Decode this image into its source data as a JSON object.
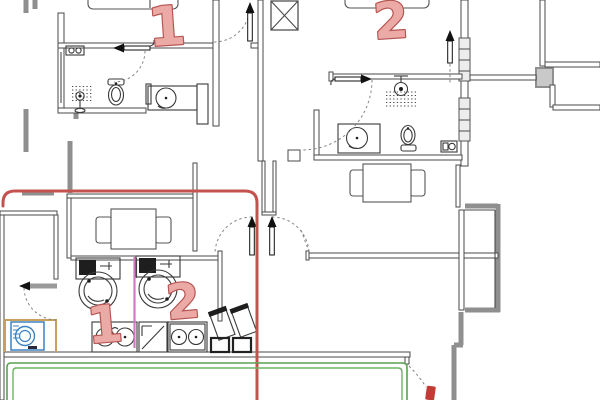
{
  "plan": {
    "type": "apartment floor plan with annotations",
    "room_labels": [
      {
        "id": "bedroom-1",
        "text": "1"
      },
      {
        "id": "bedroom-2",
        "text": "2"
      },
      {
        "id": "wash-station-1",
        "text": "1"
      },
      {
        "id": "wash-station-2",
        "text": "2"
      }
    ]
  },
  "colors": {
    "annotation_red": "#c4524e",
    "annotation_green": "#58a24f",
    "annotation_green_inner": "#6db364",
    "annotation_magenta": "#d07cc5",
    "mark_red": "#c23b36",
    "label_fill": "#ecaaa6",
    "label_stroke": "#b65653",
    "wall_gray": "#8f8f8f",
    "wall_line": "#4a4a4a",
    "appliance_blue": "#3b82c4",
    "cabinet_tan": "#c9a05b"
  }
}
